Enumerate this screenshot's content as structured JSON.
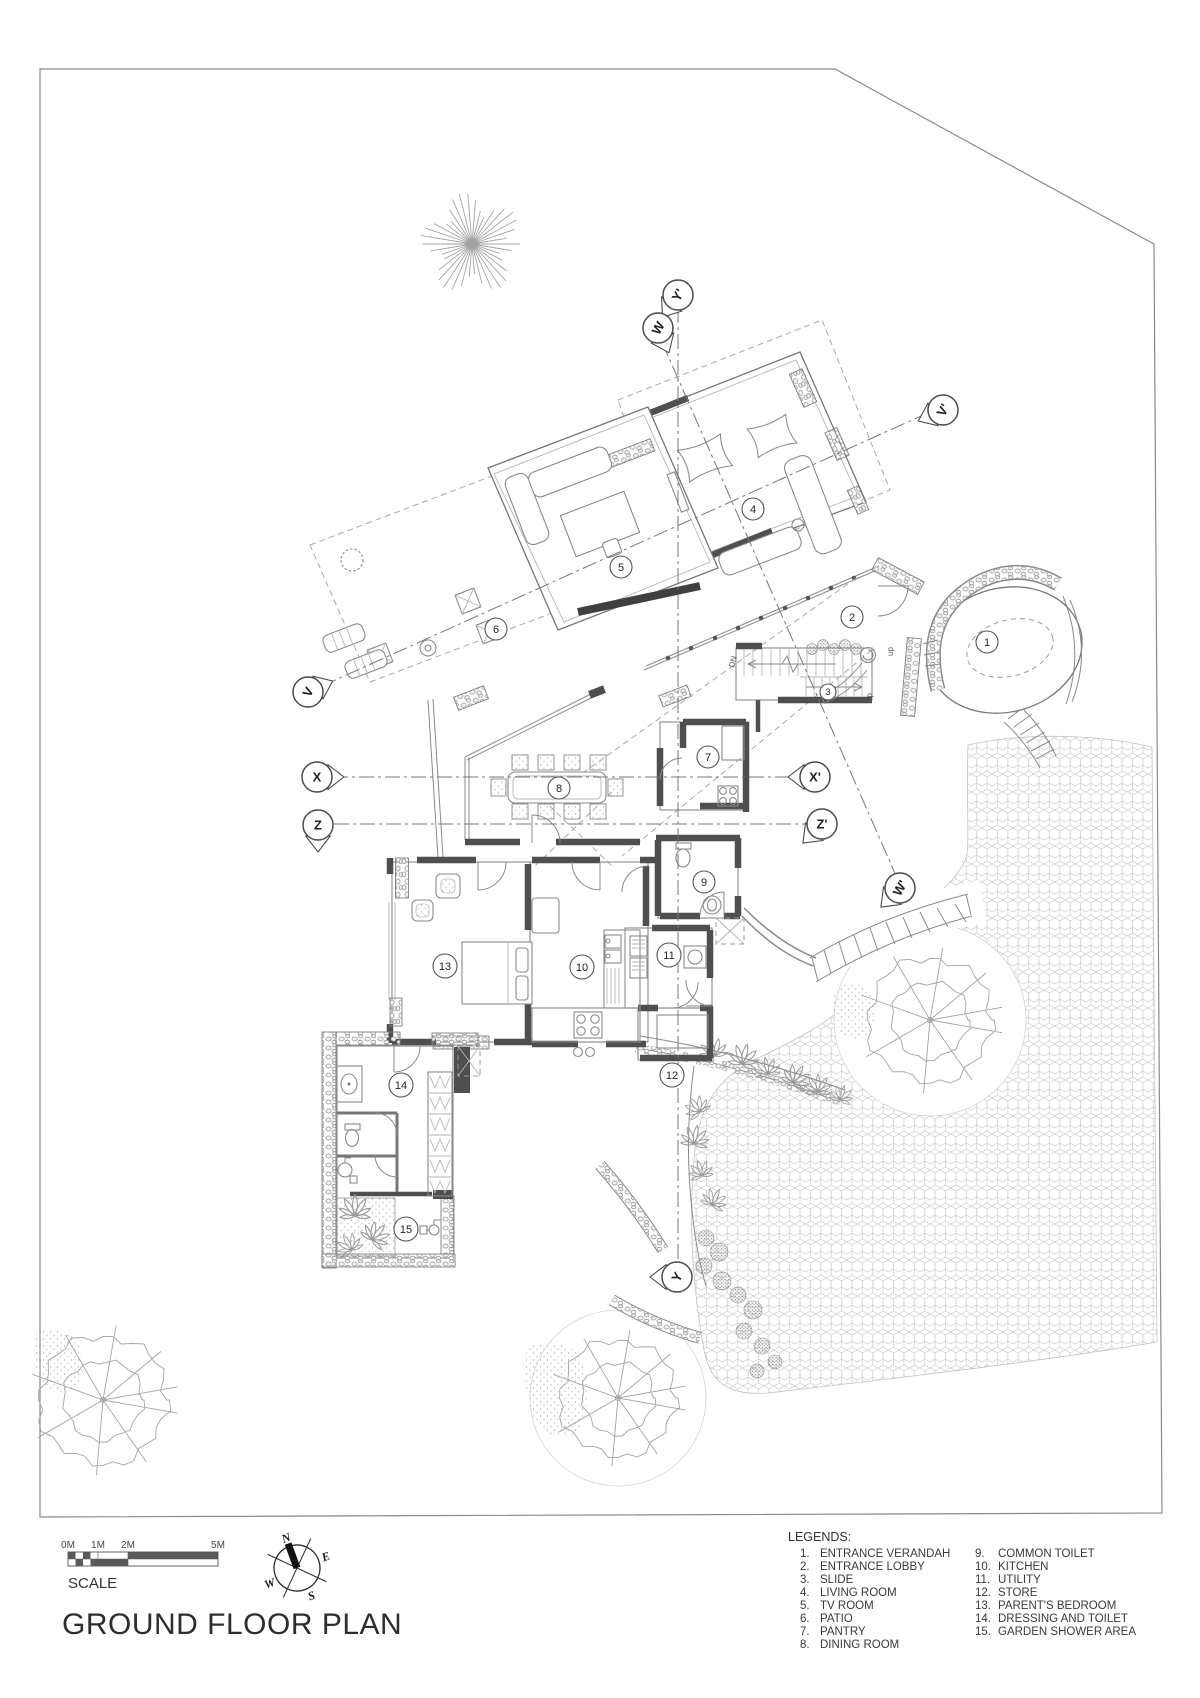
{
  "title": "GROUND FLOOR PLAN",
  "colors": {
    "paper": "#ffffff",
    "ink": "#333333",
    "wall": "#4f4f4f",
    "line": "#8a8a8a",
    "hatch": "#c8c8c8",
    "foliage": "#9c9c9c"
  },
  "scalebar": {
    "label": "SCALE",
    "marks": [
      "0M",
      "1M",
      "2M",
      "5M"
    ]
  },
  "compass": {
    "n": "N",
    "e": "E",
    "s": "S",
    "w": "W"
  },
  "plan": {
    "rooms": [
      {
        "num": "1"
      },
      {
        "num": "2"
      },
      {
        "num": "3"
      },
      {
        "num": "4"
      },
      {
        "num": "5"
      },
      {
        "num": "6"
      },
      {
        "num": "7"
      },
      {
        "num": "8"
      },
      {
        "num": "9"
      },
      {
        "num": "10"
      },
      {
        "num": "11"
      },
      {
        "num": "12"
      },
      {
        "num": "13"
      },
      {
        "num": "14"
      },
      {
        "num": "15"
      }
    ],
    "markers": [
      {
        "label": "Y'"
      },
      {
        "label": "W"
      },
      {
        "label": "V'"
      },
      {
        "label": "V"
      },
      {
        "label": "X"
      },
      {
        "label": "X'"
      },
      {
        "label": "Z"
      },
      {
        "label": "Z'"
      },
      {
        "label": "W'"
      },
      {
        "label": "Y"
      }
    ],
    "stairs": {
      "up_top": "up",
      "down": "DN",
      "up_bottom": "up"
    }
  },
  "legend": {
    "heading": "LEGENDS:",
    "left": [
      {
        "num": "1.",
        "label": "ENTRANCE VERANDAH"
      },
      {
        "num": "2.",
        "label": "ENTRANCE LOBBY"
      },
      {
        "num": "3.",
        "label": "SLIDE"
      },
      {
        "num": "4.",
        "label": "LIVING ROOM"
      },
      {
        "num": "5.",
        "label": "TV ROOM"
      },
      {
        "num": "6.",
        "label": "PATIO"
      },
      {
        "num": "7.",
        "label": "PANTRY"
      },
      {
        "num": "8.",
        "label": "DINING ROOM"
      }
    ],
    "right": [
      {
        "num": "9.",
        "label": "COMMON TOILET"
      },
      {
        "num": "10.",
        "label": "KITCHEN"
      },
      {
        "num": "11.",
        "label": "UTILITY"
      },
      {
        "num": "12.",
        "label": "STORE"
      },
      {
        "num": "13.",
        "label": "PARENT'S BEDROOM"
      },
      {
        "num": "14.",
        "label": "DRESSING AND TOILET"
      },
      {
        "num": "15.",
        "label": "GARDEN SHOWER AREA"
      }
    ]
  }
}
